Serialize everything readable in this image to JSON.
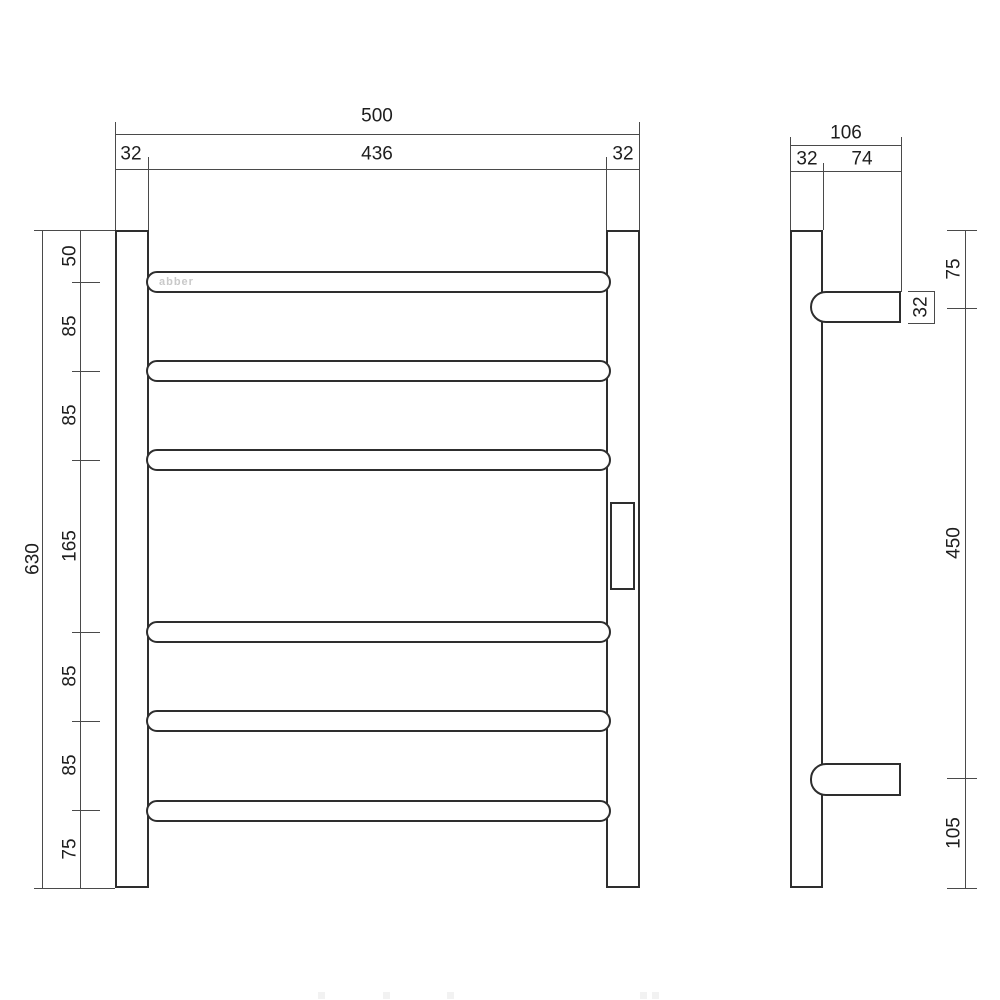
{
  "drawing": {
    "brand": "abber",
    "front": {
      "width_total": "500",
      "width_inner": "436",
      "width_side_left": "32",
      "width_side_right": "32",
      "height_total": "630",
      "segments": [
        "50",
        "85",
        "85",
        "165",
        "85",
        "85",
        "75"
      ]
    },
    "side": {
      "depth_total": "106",
      "tube_depth": "32",
      "arm_length": "74",
      "arm_thickness": "32",
      "offset_top": "75",
      "bracket_span": "450",
      "offset_bottom": "105"
    }
  }
}
